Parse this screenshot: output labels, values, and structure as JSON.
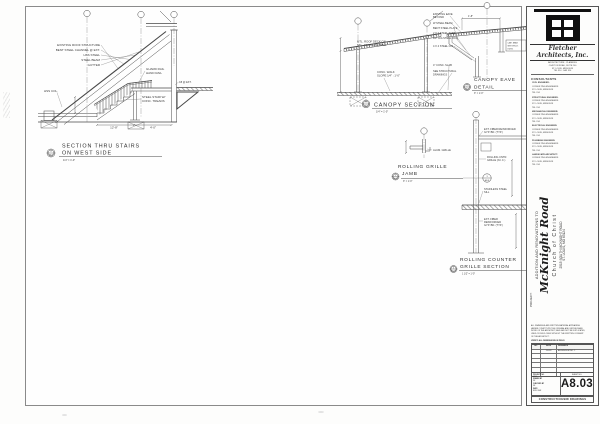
{
  "stair": {
    "t1": "SECTION THRU STAIRS",
    "t2": "ON WEST SIDE",
    "scale": "1/4\" = 1'-0\"",
    "bub_n": "4",
    "bub_s": "A8.03",
    "a1": "EXISTING ROOF STRUCTURE",
    "a2": "BENT STEEL CHANNEL @ EXT.",
    "a3": "HSS STEEL",
    "a4": "STEEL BEAM",
    "a5": "GUTTER",
    "a6": "GUARD RAIL",
    "a7": "HAND RAIL",
    "a8": "C8 @ EXT.",
    "a9": "STEEL STAIR W/",
    "a10": "CONC. TREADS",
    "a11": "HSS COL.",
    "d1": "12'-8\"",
    "d2": "4'-0\""
  },
  "canopy": {
    "title": "CANOPY SECTION",
    "scale": "1/4\" = 1'-0\"",
    "bub_n": "1",
    "bub_s": "A8.03",
    "deck1": "MTL. ROOF DECK ON",
    "deck2": "STL. JOISTS, SLOPED",
    "walk1": "CONC. WALK",
    "walk2": "SLOPE 1/4\" : 1'-0\""
  },
  "eave": {
    "title1": "CANOPY EAVE",
    "title2": "DETAIL",
    "scale": "3\" = 1'-0\"",
    "bub_n": "2",
    "bub_s": "A8.03",
    "dim": "1'-8\"",
    "ann": [
      "EXISTING EAVE",
      "BEYOND",
      "W STEEL BEAM",
      "BENT STEEL PLATE",
      "2 X 2 STEEL TUBE",
      "1/2\" DIA STEEL ROD",
      "4 X 4 STEEL COL.",
      "4\" CONC. SLAB",
      "SEE STRUCTURAL",
      "DRAWINGS"
    ],
    "note1": "CANT. BEAM",
    "note2": "SEE STRUCT.",
    "note3": "DWGS."
  },
  "grille": {
    "title1": "ROLLING GRILLE",
    "title2": "JAMB",
    "scale": "3\" = 1'-0\"",
    "bub_n": "5",
    "bub_s": "A8.03",
    "ann1": "ALUM. GRILLE"
  },
  "counter": {
    "title1": "ROLLING COUNTER",
    "title2": "GRILLE SECTION",
    "scale": "1 1/2\" = 1'-0\"",
    "bub_n": "6",
    "bub_s": "A8.03",
    "l1a": "EXT. FIBER REINFORCED",
    "l1b": "GYP. BD. (TYP.)",
    "l2a": "ROLLING CNTR.",
    "l2b": "GRILLE (N.I.C.)",
    "l3a": "STAINLESS STEEL",
    "l3b": "SILL",
    "l4a": "EXT. FIBER",
    "l4b": "REINFORCED",
    "l4c": "GYP. BD. (TYP.)",
    "bub_top": "3",
    "bub_bot": "A8.03"
  },
  "titleblock": {
    "firm1": "Fletcher",
    "firm2": "Architects, Inc.",
    "address_lines": [
      "ARCHITECTURE · PLANNING",
      "CLAYTON ROAD, SUITE 200",
      "ST. LOUIS, MISSOURI",
      "TEL 314 · FAX 314"
    ],
    "consultants_heading": "CONSULTANTS",
    "consultants": [
      "CIVIL ENGINEER:",
      "CONSULTING ENGINEERS",
      "ST. LOUIS, MISSOURI",
      "TEL 314",
      "STRUCTURAL ENGINEER:",
      "CONSULTING ENGINEERS",
      "ST. LOUIS, MISSOURI",
      "TEL 314",
      "MECHANICAL ENGINEER:",
      "CONSULTING ENGINEERS",
      "ST. LOUIS, MISSOURI",
      "TEL 314",
      "ELECTRICAL ENGINEER:",
      "CONSULTING ENGINEERS",
      "ST. LOUIS, MISSOURI",
      "TEL 314",
      "PLUMBING ENGINEER:",
      "CONSULTING ENGINEERS",
      "ST. LOUIS, MISSOURI",
      "TEL 314",
      "LANDSCAPE ARCHITECT:",
      "CONSULTING ENGINEERS",
      "ST. LOUIS, MISSOURI",
      "TEL 314"
    ],
    "project": {
      "label": "PROJECT:",
      "prefix": "ADDITION AND RENOVATIONS TO",
      "name": "McKnight Road",
      "name2": "Church  of  Christ",
      "addr1": "2515 SOUTH MCKNIGHT ROAD",
      "addr2": "ST. LOUIS, MO 63124"
    },
    "notes": [
      "ALL DRAWINGS AND WRITTEN MATERIAL APPEARING",
      "HEREIN CONSTITUTE THE ORIGINAL AND UNPUBLISHED",
      "WORK OF THE ARCHITECT, AND MAY NOT BE DUPLICATED,",
      "USED OR DISCLOSED WITHOUT THE WRITTEN CONSENT",
      "OF THE ARCHITECT."
    ],
    "note_line": "VERIFY ALL DIMENSIONS IN FIELD",
    "rev_headers": [
      "NO.",
      "DATE",
      "REMARKS"
    ],
    "rev_row": {
      "no": "",
      "date": "1-6-03",
      "remark": "ADDENDUM NO. 1"
    },
    "fields": [
      {
        "label": "PROJECT NO.",
        "value": "0204"
      },
      {
        "label": "DRAWN BY",
        "value": "DF"
      },
      {
        "label": "CHECKED BY",
        "value": "DF"
      },
      {
        "label": "DATE",
        "value": "NOV. 2002"
      }
    ],
    "sheet_label": "SHEET NO.",
    "sheet_no": "A8.03",
    "footer": "CONSTRUCTION/BID DRAWINGS"
  }
}
